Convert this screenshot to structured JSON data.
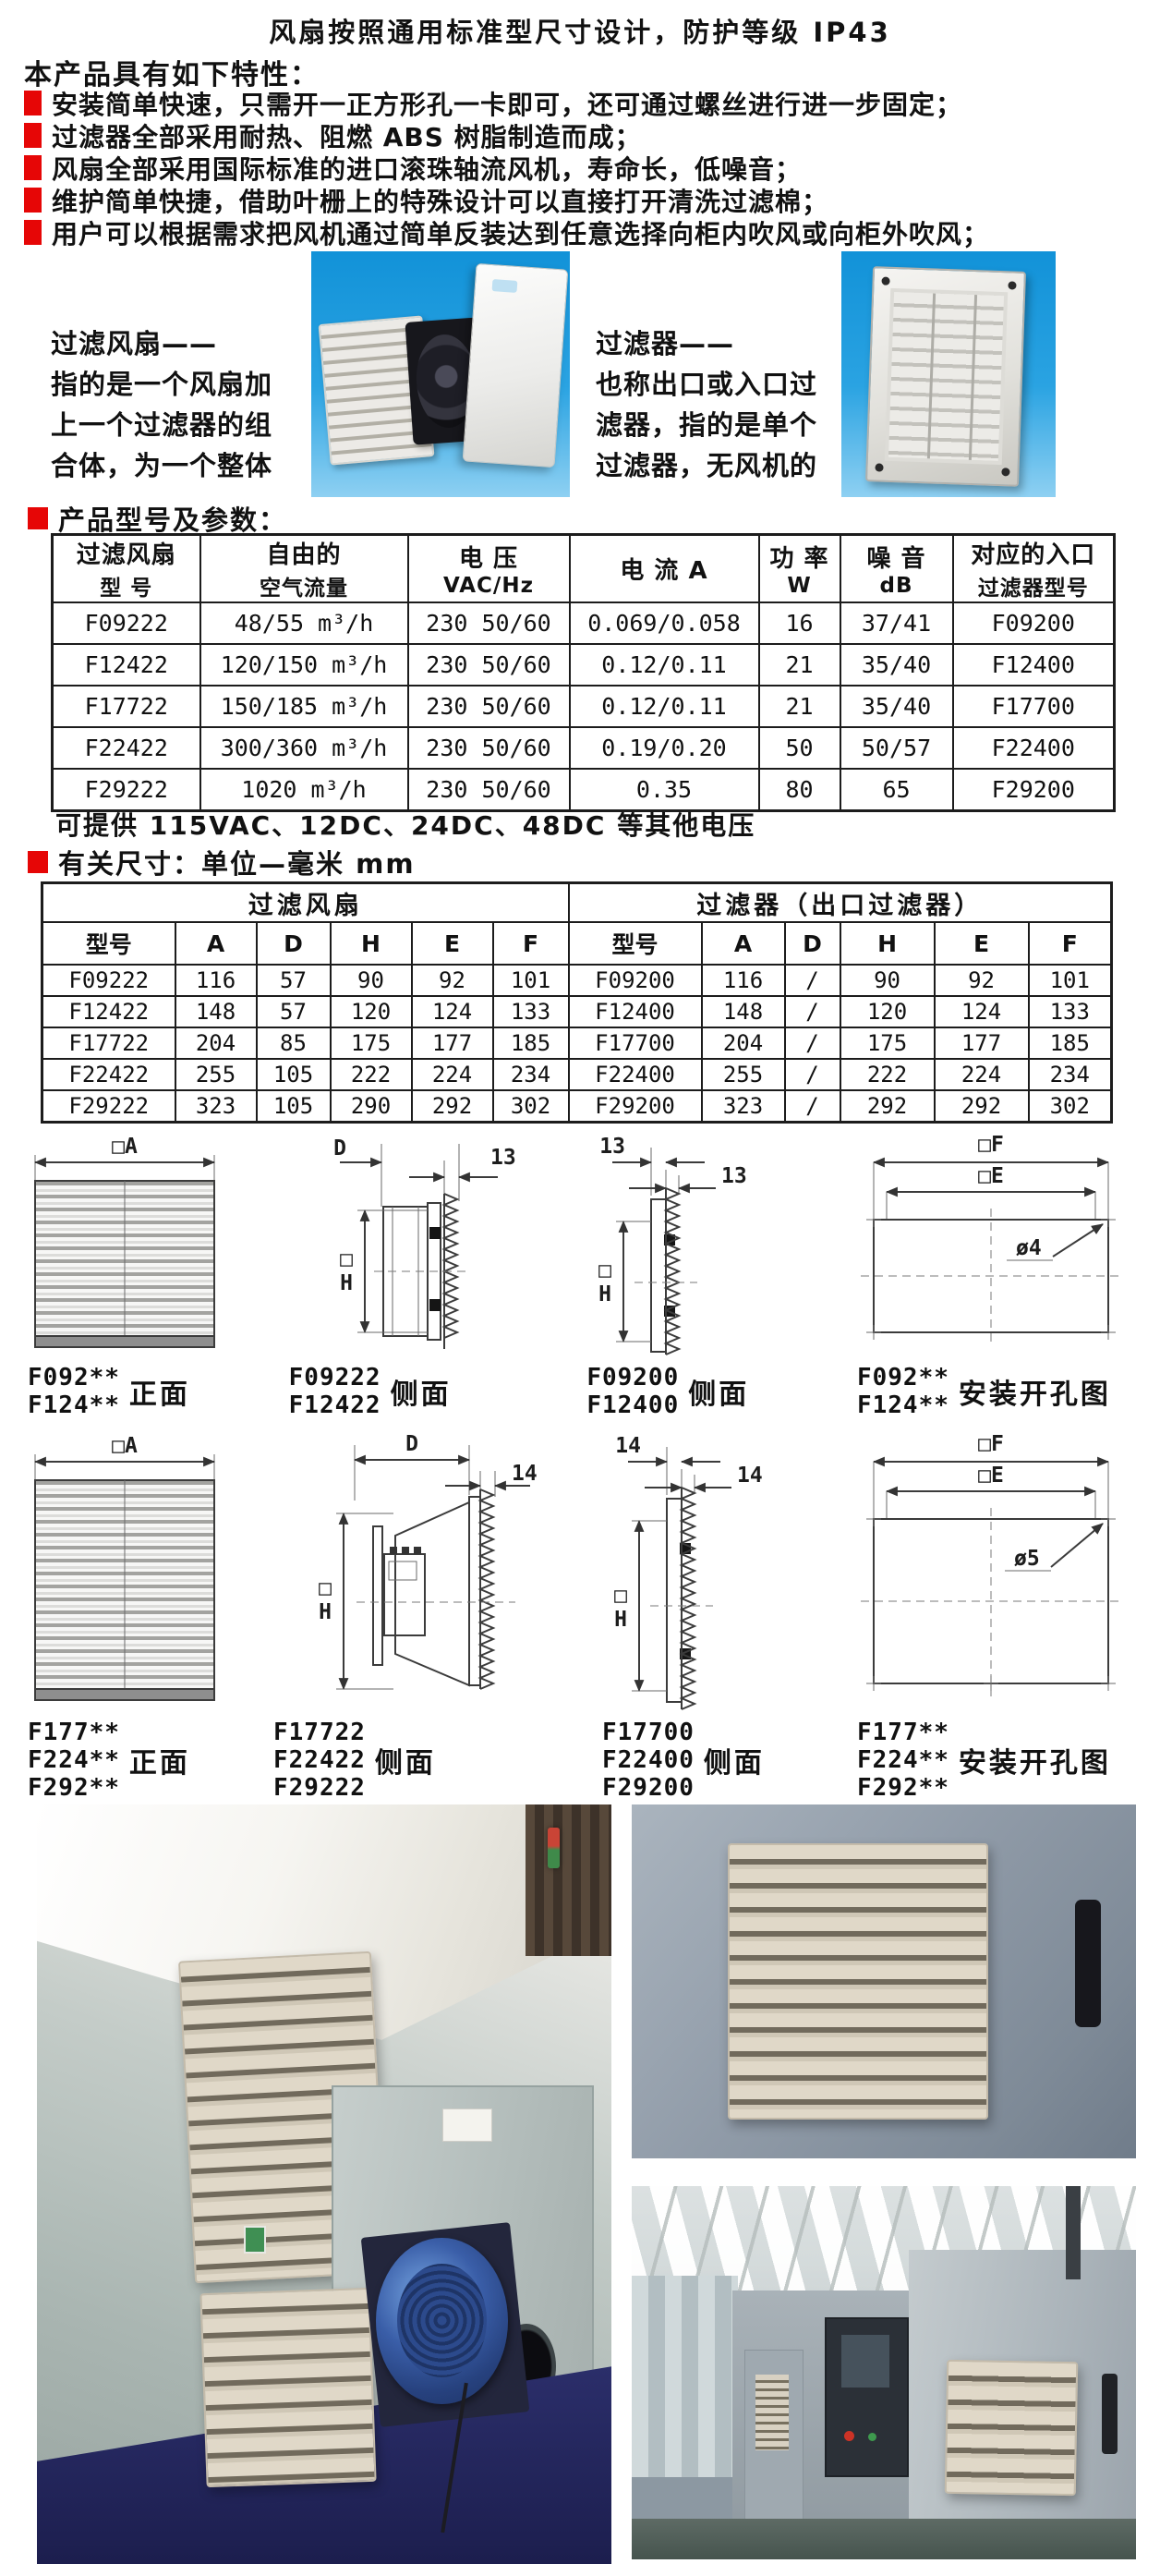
{
  "colors": {
    "accent_red": "#e60606",
    "image_blue": "#1292d8",
    "filter_beige": "#d6cdbb",
    "navy_base": "#222561"
  },
  "header": {
    "title": "风扇按照通用标准型尺寸设计，防护等级 IP43",
    "intro": "本产品具有如下特性：",
    "features": [
      "安装简单快速，只需开一正方形孔一卡即可，还可通过螺丝进行进一步固定；",
      "过滤器全部采用耐热、阻燃 ABS 树脂制造而成；",
      "风扇全部采用国际标准的进口滚珠轴流风机，寿命长，低噪音；",
      "维护简单快捷，借助叶栅上的特殊设计可以直接打开清洗过滤棉；",
      "用户可以根据需求把风机通过简单反装达到任意选择向柜内吹风或向柜外吹风；"
    ]
  },
  "overview": {
    "fan_text": {
      "lines": [
        "过滤风扇——",
        "指的是一个风扇加",
        "上一个过滤器的组",
        "合体，为一个整体"
      ]
    },
    "filter_text": {
      "lines": [
        "过滤器——",
        "也称出口或入口过",
        "滤器，指的是单个",
        "过滤器，无风机的"
      ]
    }
  },
  "spec_table": {
    "section_title": "产品型号及参数：",
    "headers": [
      [
        "过滤风扇",
        "型  号"
      ],
      [
        "自由的",
        "空气流量"
      ],
      [
        "电  压",
        "VAC/Hz"
      ],
      [
        "电 流  A",
        ""
      ],
      [
        "功 率",
        "W"
      ],
      [
        "噪 音",
        "dB"
      ],
      [
        "对应的入口",
        "过滤器型号"
      ]
    ],
    "rows": [
      [
        "F09222",
        "48/55 m³/h",
        "230 50/60",
        "0.069/0.058",
        "16",
        "37/41",
        "F09200"
      ],
      [
        "F12422",
        "120/150 m³/h",
        "230 50/60",
        "0.12/0.11",
        "21",
        "35/40",
        "F12400"
      ],
      [
        "F17722",
        "150/185 m³/h",
        "230 50/60",
        "0.12/0.11",
        "21",
        "35/40",
        "F17700"
      ],
      [
        "F22422",
        "300/360 m³/h",
        "230 50/60",
        "0.19/0.20",
        "50",
        "50/57",
        "F22400"
      ],
      [
        "F29222",
        "1020 m³/h",
        "230 50/60",
        "0.35",
        "80",
        "65",
        "F29200"
      ]
    ],
    "footnote": "可提供 115VAC、12DC、24DC、48DC 等其他电压"
  },
  "dim_table": {
    "section_title": "有关尺寸：单位—毫米 mm",
    "groups": [
      "过滤风扇",
      "过滤器（出口过滤器）"
    ],
    "sub_headers": [
      "型号",
      "A",
      "D",
      "H",
      "E",
      "F",
      "型号",
      "A",
      "D",
      "H",
      "E",
      "F"
    ],
    "rows": [
      [
        "F09222",
        "116",
        "57",
        "90",
        "92",
        "101",
        "F09200",
        "116",
        "/",
        "90",
        "92",
        "101"
      ],
      [
        "F12422",
        "148",
        "57",
        "120",
        "124",
        "133",
        "F12400",
        "148",
        "/",
        "120",
        "124",
        "133"
      ],
      [
        "F17722",
        "204",
        "85",
        "175",
        "177",
        "185",
        "F17700",
        "204",
        "/",
        "175",
        "177",
        "185"
      ],
      [
        "F22422",
        "255",
        "105",
        "222",
        "224",
        "234",
        "F22400",
        "255",
        "/",
        "222",
        "224",
        "234"
      ],
      [
        "F29222",
        "323",
        "105",
        "290",
        "292",
        "302",
        "F29200",
        "323",
        "/",
        "292",
        "292",
        "302"
      ]
    ]
  },
  "drawings": {
    "row1": [
      {
        "models": [
          "F092**",
          "F124**"
        ],
        "label": "正面",
        "dims": [
          "□A"
        ]
      },
      {
        "models": [
          "F09222",
          "F12422"
        ],
        "label": "侧面",
        "dims": [
          "D",
          "13",
          "□H"
        ]
      },
      {
        "models": [
          "F09200",
          "F12400"
        ],
        "label": "侧面",
        "dims": [
          "13",
          "13",
          "□H"
        ]
      },
      {
        "models": [
          "F092**",
          "F124**"
        ],
        "label": "安装开孔图",
        "dims": [
          "□F",
          "□E",
          "ø4"
        ]
      }
    ],
    "row2": [
      {
        "models": [
          "F177**",
          "F224**",
          "F292**"
        ],
        "label": "正面",
        "dims": [
          "□A"
        ]
      },
      {
        "models": [
          "F17722",
          "F22422",
          "F29222"
        ],
        "label": "侧面",
        "dims": [
          "D",
          "14",
          "□H"
        ]
      },
      {
        "models": [
          "F17700",
          "F22400",
          "F29200"
        ],
        "label": "侧面",
        "dims": [
          "14",
          "14",
          "□H"
        ]
      },
      {
        "models": [
          "F177**",
          "F224**",
          "F292**"
        ],
        "label": "安装开孔图",
        "dims": [
          "□F",
          "□E",
          "ø5"
        ]
      }
    ]
  }
}
